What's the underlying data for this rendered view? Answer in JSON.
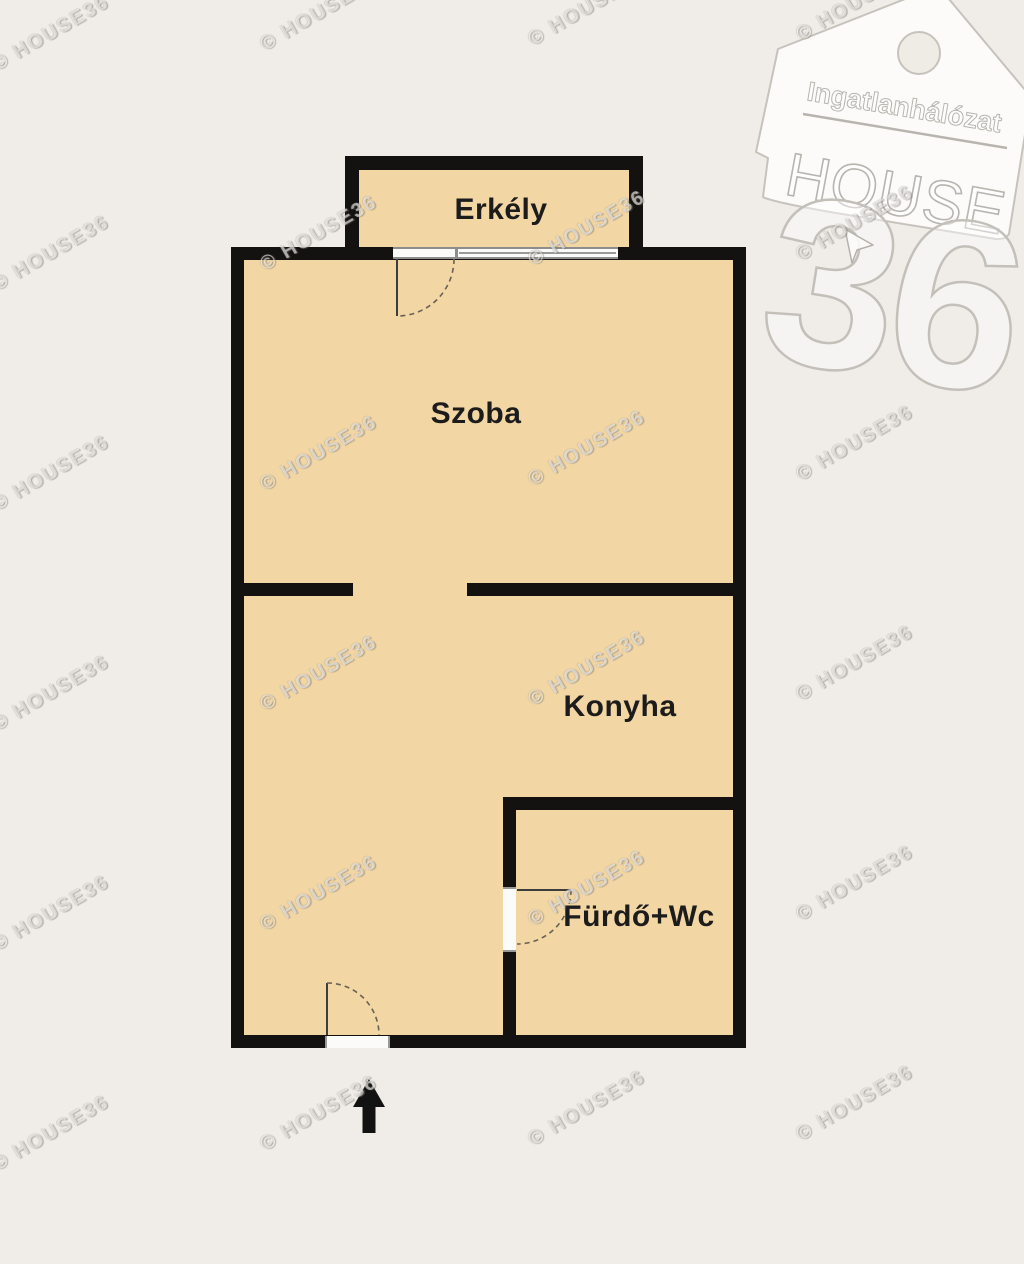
{
  "page": {
    "type": "apartment-floor-plan",
    "language": "hu"
  },
  "colors": {
    "bg": "#f0ede8",
    "wall": "#141210",
    "floor": "#f2d6a4",
    "label": "#1c1c1c",
    "logoline": "#bdbab4"
  },
  "rooms": [
    {
      "id": "erkely",
      "label": "Erkély"
    },
    {
      "id": "szoba",
      "label": "Szoba"
    },
    {
      "id": "konyha",
      "label": "Konyha"
    },
    {
      "id": "furdo-wc",
      "label": "Fürdő+Wc"
    }
  ],
  "watermark": {
    "text": "© HOUSE36"
  },
  "logo": {
    "brand_top": "Ingatlanhálózat",
    "brand_main": "HOUSE",
    "brand_number": "36"
  },
  "icons": {
    "entrance_arrow": "arrow-up-icon",
    "pointer": "mouse-cursor-icon",
    "logo_shape": "house-tag-icon"
  }
}
